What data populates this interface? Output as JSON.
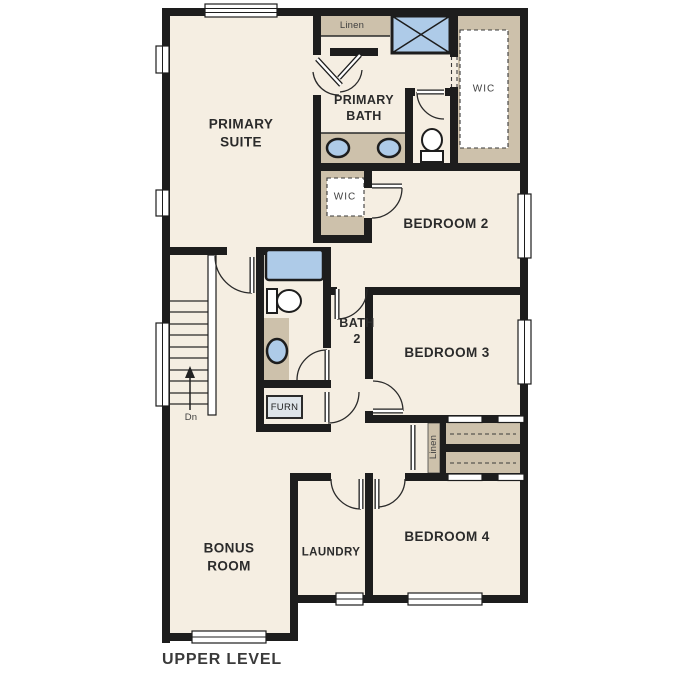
{
  "title": "UPPER LEVEL",
  "colors": {
    "floor": "#f5eee2",
    "wall": "#1d1d1d",
    "closet_tan": "#cdc1ab",
    "fixture_blue": "#aecbe8",
    "furn_fill": "#dfe5ea",
    "text_dark": "#2b2b2b",
    "text_muted": "#3f3f3f"
  },
  "rooms": {
    "primary_suite": "PRIMARY\nSUITE",
    "primary_bath": "PRIMARY\nBATH",
    "bedroom2": "BEDROOM 2",
    "bedroom3": "BEDROOM 3",
    "bedroom4": "BEDROOM 4",
    "bonus_room": "BONUS\nROOM",
    "laundry": "LAUNDRY",
    "bath2": "BATH\n2"
  },
  "closets": {
    "linen_upper": "Linen",
    "primary_wic": "WIC",
    "bedroom2_wic": "WIC",
    "hall_linen": "Linen"
  },
  "labels": {
    "stair_direction": "Dn",
    "furnace": "FURN"
  }
}
